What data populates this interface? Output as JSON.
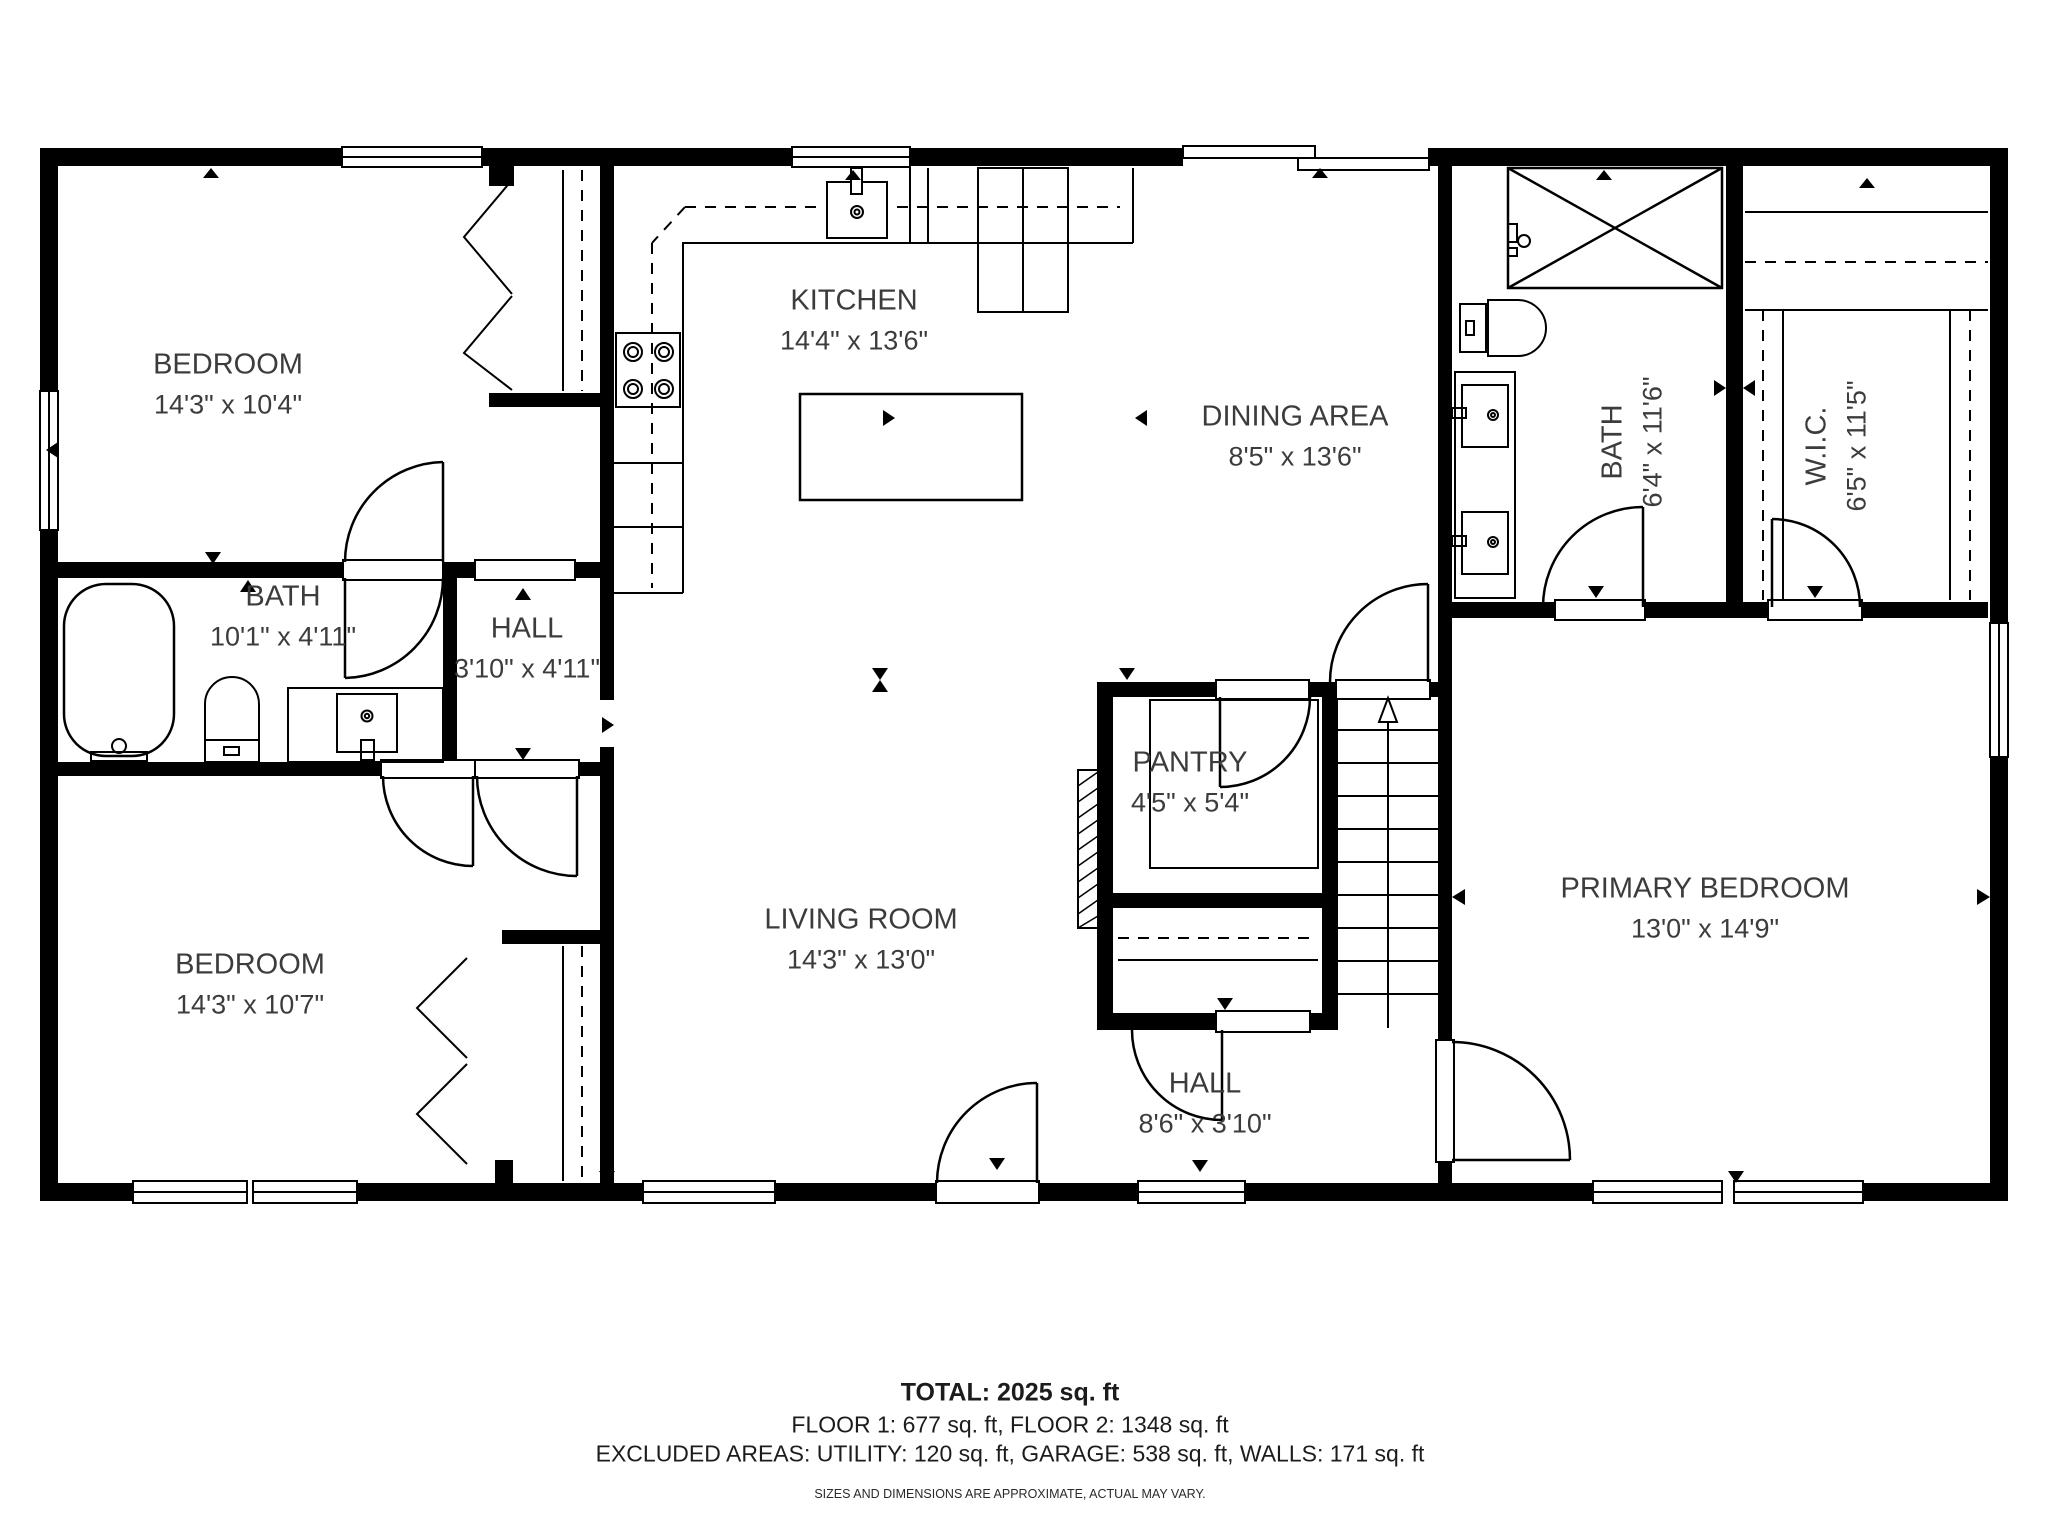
{
  "document": {
    "type": "floor-plan"
  },
  "rooms": [
    {
      "id": "bedroom-1",
      "name": "BEDROOM",
      "dims": "14'3\" x 10'4\""
    },
    {
      "id": "kitchen",
      "name": "KITCHEN",
      "dims": "14'4\" x 13'6\""
    },
    {
      "id": "dining-area",
      "name": "DINING AREA",
      "dims": "8'5\" x 13'6\""
    },
    {
      "id": "bath-upper",
      "name": "BATH",
      "dims": "6'4\" x 11'6\""
    },
    {
      "id": "wic",
      "name": "W.I.C.",
      "dims": "6'5\" x 11'5\""
    },
    {
      "id": "bath-main",
      "name": "BATH",
      "dims": "10'1\" x 4'11\""
    },
    {
      "id": "hall-small",
      "name": "HALL",
      "dims": "3'10\" x 4'11\""
    },
    {
      "id": "bedroom-2",
      "name": "BEDROOM",
      "dims": "14'3\" x 10'7\""
    },
    {
      "id": "living-room",
      "name": "LIVING ROOM",
      "dims": "14'3\" x 13'0\""
    },
    {
      "id": "pantry",
      "name": "PANTRY",
      "dims": "4'5\" x 5'4\""
    },
    {
      "id": "primary-bedroom",
      "name": "PRIMARY BEDROOM",
      "dims": "13'0\" x 14'9\""
    },
    {
      "id": "hall-lower",
      "name": "HALL",
      "dims": "8'6\" x 3'10\""
    }
  ],
  "footer": {
    "total": "TOTAL: 2025 sq. ft",
    "floors": "FLOOR 1: 677 sq. ft, FLOOR 2: 1348 sq. ft",
    "excluded": "EXCLUDED AREAS: UTILITY: 120 sq. ft, GARAGE: 538 sq. ft, WALLS: 171 sq. ft",
    "disclaimer": "SIZES AND DIMENSIONS ARE APPROXIMATE, ACTUAL MAY VARY."
  },
  "colors": {
    "wall": "#000000",
    "line": "#000000",
    "text": "#3c3c3c"
  }
}
